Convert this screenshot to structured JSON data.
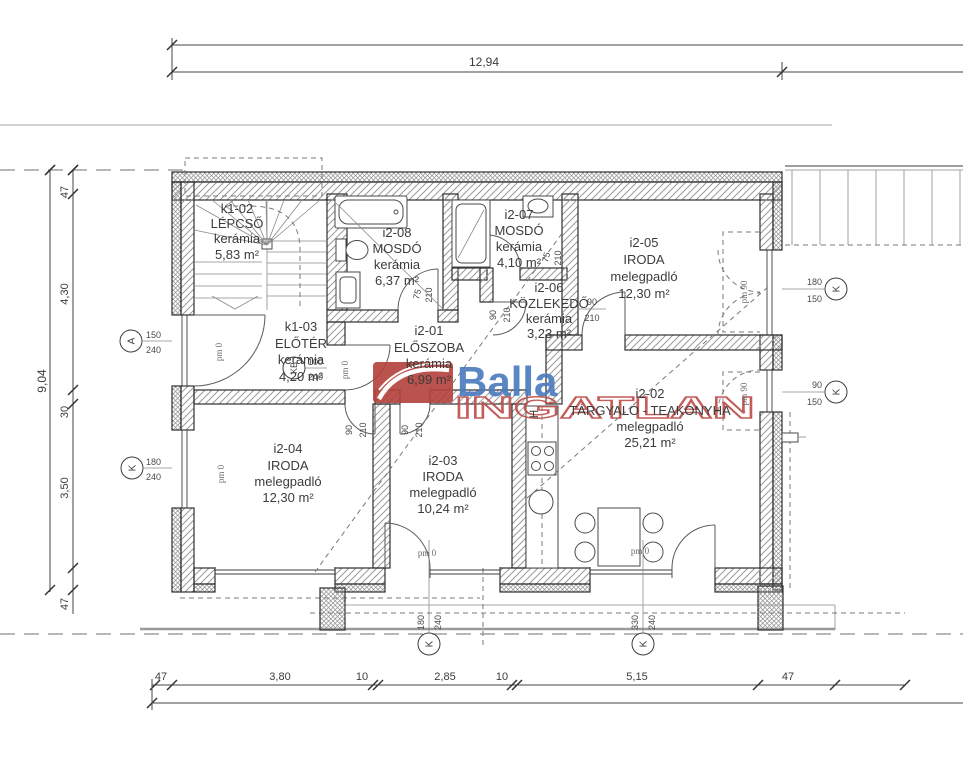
{
  "watermark": {
    "brand": "Balla",
    "subtitle": "INGATLAN"
  },
  "dimensions": {
    "top_total": "12,94",
    "left_total": "9,04",
    "left_chain": [
      "47",
      "4,30",
      "30",
      "3,50",
      "47"
    ],
    "bottom_chain": [
      "47",
      "3,80",
      "10",
      "2,85",
      "10",
      "5,15",
      "47"
    ]
  },
  "rooms": [
    {
      "code": "k1-02",
      "name": "LÉPCSŐ",
      "finish": "kerámia",
      "area": "5,83 m²"
    },
    {
      "code": "i2-08",
      "name": "MOSDÓ",
      "finish": "kerámia",
      "area": "6,37 m²"
    },
    {
      "code": "i2-07",
      "name": "MOSDÓ",
      "finish": "kerámia",
      "area": "4,10 m²"
    },
    {
      "code": "i2-05",
      "name": "IRODA",
      "finish": "melegpadló",
      "area": "12,30 m²"
    },
    {
      "code": "i2-06",
      "name": "KÖZLEKEDŐ",
      "finish": "kerámia",
      "area": "3,23 m²"
    },
    {
      "code": "k1-03",
      "name": "ELŐTÉR",
      "finish": "kerámia",
      "area": "4,20 m²"
    },
    {
      "code": "i2-01",
      "name": "ELŐSZOBA",
      "finish": "kerámia",
      "area": "6,99 m²"
    },
    {
      "code": "i2-02",
      "name": "TÁRGYALÓ - TEAKONYHA",
      "finish": "melegpadló",
      "area": "25,21 m²"
    },
    {
      "code": "i2-04",
      "name": "IRODA",
      "finish": "melegpadló",
      "area": "12,30 m²"
    },
    {
      "code": "i2-03",
      "name": "IRODA",
      "finish": "melegpadló",
      "area": "10,24 m²"
    }
  ],
  "openings": [
    {
      "tag": "A",
      "a": "150",
      "b": "240"
    },
    {
      "tag": "K",
      "a": "180",
      "b": "240"
    },
    {
      "tag": "KB",
      "a": "100",
      "b": "240"
    },
    {
      "tag": "K",
      "a": "180",
      "b": "240"
    },
    {
      "tag": "K",
      "a": "330",
      "b": "240"
    },
    {
      "tag": "K",
      "a": "180",
      "b": "150"
    },
    {
      "tag": "K",
      "a": "90",
      "b": "150"
    }
  ],
  "door_sizes": {
    "w90": "90",
    "w75": "75",
    "h210": "210"
  },
  "floor_marks": {
    "pm0": "pm 0",
    "pm90": "pm 90"
  },
  "symbols": {
    "h": "H"
  },
  "colors": {
    "brand_blue": "#4d7cbe",
    "brand_red": "#b5443e",
    "line": "#3c3c3c"
  }
}
